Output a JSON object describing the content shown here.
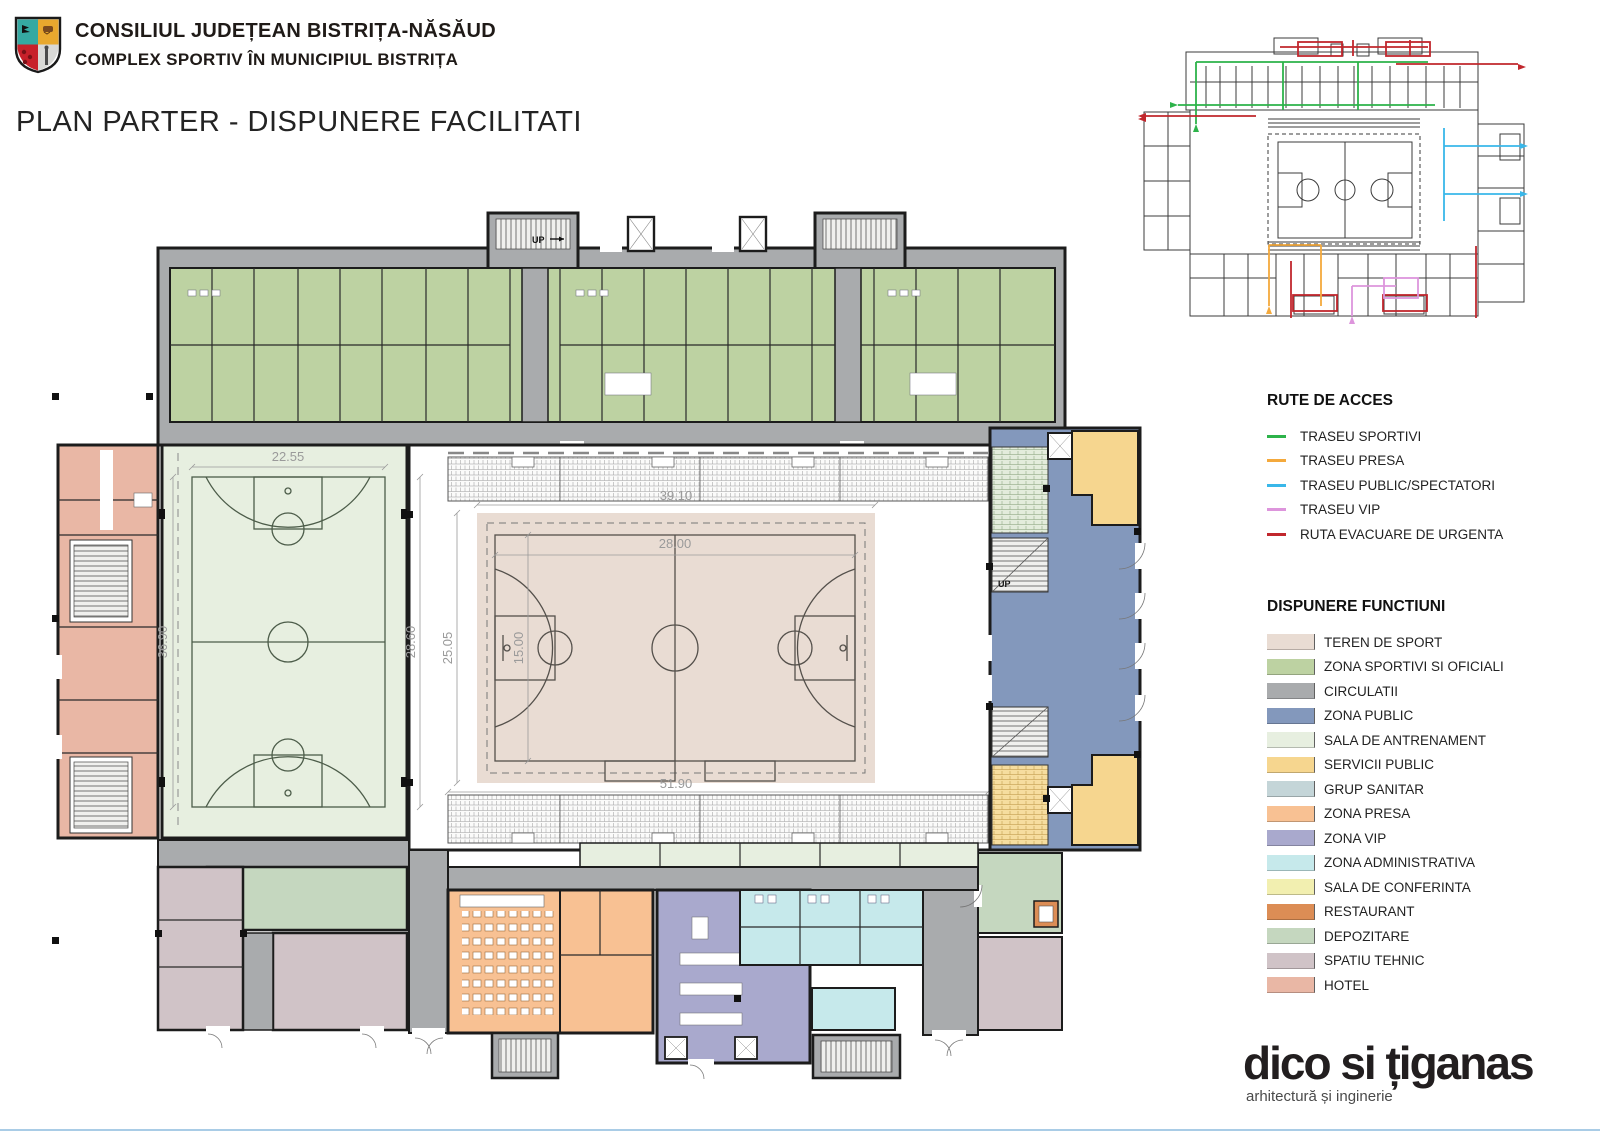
{
  "header": {
    "org": "CONSILIUL JUDEȚEAN BISTRIȚA-NĂSĂUD",
    "project": "COMPLEX SPORTIV ÎN MUNICIPIUL BISTRIȚA",
    "title": "PLAN PARTER - DISPUNERE FACILITATI"
  },
  "routes_legend": {
    "title": "RUTE DE ACCES",
    "items": [
      {
        "label": "TRASEU SPORTIVI",
        "key": "r_sport"
      },
      {
        "label": "TRASEU PRESA",
        "key": "r_presa"
      },
      {
        "label": "TRASEU PUBLIC/SPECTATORI",
        "key": "r_public"
      },
      {
        "label": "TRASEU VIP",
        "key": "r_vip"
      },
      {
        "label": "RUTA EVACUARE DE URGENTA",
        "key": "r_evac"
      }
    ]
  },
  "functions_legend": {
    "title": "DISPUNERE FUNCTIUNI",
    "items": [
      {
        "label": "TEREN DE SPORT",
        "key": "teren"
      },
      {
        "label": "ZONA SPORTIVI SI OFICIALI",
        "key": "sportivi"
      },
      {
        "label": "CIRCULATII",
        "key": "circ"
      },
      {
        "label": "ZONA PUBLIC",
        "key": "public"
      },
      {
        "label": "SALA DE ANTRENAMENT",
        "key": "antren"
      },
      {
        "label": "SERVICII PUBLIC",
        "key": "servicii"
      },
      {
        "label": "GRUP SANITAR",
        "key": "sanitar"
      },
      {
        "label": "ZONA PRESA",
        "key": "presa"
      },
      {
        "label": "ZONA VIP",
        "key": "vip"
      },
      {
        "label": "ZONA ADMINISTRATIVA",
        "key": "admin"
      },
      {
        "label": "SALA DE CONFERINTA",
        "key": "conf"
      },
      {
        "label": "RESTAURANT",
        "key": "rest"
      },
      {
        "label": "DEPOZITARE",
        "key": "depo"
      },
      {
        "label": "SPATIU TEHNIC",
        "key": "tehnic"
      },
      {
        "label": "HOTEL",
        "key": "hotel"
      }
    ]
  },
  "plan": {
    "dims": {
      "d2255": "22.55",
      "d3690": "36.90",
      "d2860": "28.60",
      "d2505": "25.05",
      "d1500": "15.00",
      "d3910": "39.10",
      "d2800": "28.00",
      "d5190": "51.90"
    },
    "up": "UP"
  },
  "logo": {
    "name": "dico si țiganas",
    "tagline": "arhitectură și inginerie"
  },
  "colors": {
    "teren": "#e9dcd3",
    "sportivi": "#bdd2a2",
    "circ": "#a9abad",
    "public": "#8398bc",
    "antren": "#e7efe0",
    "servicii": "#f6d68f",
    "sanitar": "#c4d5d8",
    "presa": "#f8c193",
    "vip": "#a9a9cd",
    "admin": "#c6e9eb",
    "conf": "#f2efb0",
    "rest": "#dc8d55",
    "depo": "#c5d7bf",
    "tehnic": "#d0c3c7",
    "hotel": "#e9b7a5",
    "r_sport": "#2db34a",
    "r_presa": "#f4a93c",
    "r_public": "#39b7e9",
    "r_vip": "#dd95dc",
    "r_evac": "#c1272d",
    "wall": "#1c1c1c",
    "dimgray": "#9a9a9a"
  }
}
